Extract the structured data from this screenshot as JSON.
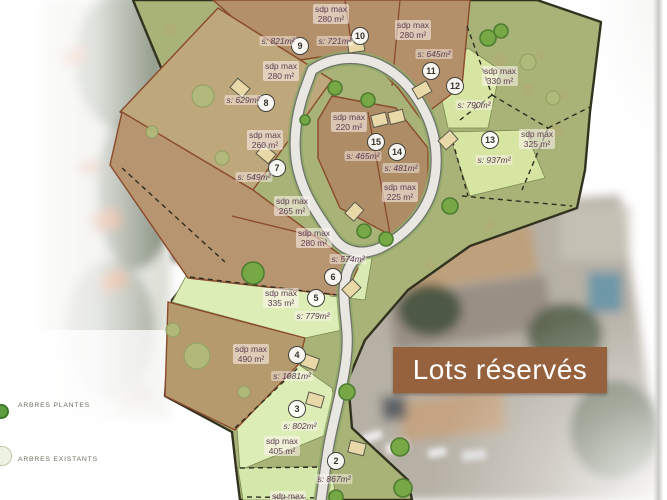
{
  "banner": {
    "label": "Lots réservés"
  },
  "legend": {
    "items": [
      {
        "label": "ARBRES PLANTES"
      },
      {
        "label": "ARBRES EXISTANTS"
      }
    ]
  },
  "lots": [
    {
      "num": "2",
      "sdp_title": "sdp max",
      "sdp_value": "405 m²",
      "surface": "s: 867m²"
    },
    {
      "num": "3",
      "surface": "s: 802m²"
    },
    {
      "num": "4",
      "sdp_title": "sdp max",
      "sdp_value": "490 m²",
      "surface": "s: 1081m²"
    },
    {
      "num": "5",
      "sdp_title": "sdp max",
      "sdp_value": "335 m²",
      "surface": "s: 779m²"
    },
    {
      "num": "6",
      "sdp_title": "sdp max",
      "sdp_value": "280 m²",
      "surface": "s: 574m²"
    },
    {
      "num": "7",
      "sdp_title": "sdp max",
      "sdp_value": "260 m²",
      "surface": "s: 549m²"
    },
    {
      "num": "8",
      "sdp_title": "sdp max",
      "sdp_value": "280 m²",
      "surface": "s: 629m²"
    },
    {
      "num": "9",
      "surface": "s: 821m²"
    },
    {
      "num": "10",
      "sdp_title": "sdp max",
      "sdp_value": "280 m²",
      "surface": "s: 721m²"
    },
    {
      "num": "11",
      "sdp_title": "sdp max",
      "sdp_value": "280 m²",
      "surface": "s: 645m²"
    },
    {
      "num": "12",
      "sdp_title": "sdp max",
      "sdp_value": "330 m²",
      "surface": "s: 790m²"
    },
    {
      "num": "13",
      "sdp_title": "sdp max",
      "sdp_value": "325 m²",
      "surface": "s: 937m²"
    },
    {
      "num": "14",
      "sdp_title": "sdp max",
      "sdp_value": "225 m²",
      "surface": "s: 481m²"
    },
    {
      "num": "15",
      "sdp_title": "sdp max",
      "sdp_value": "220 m²",
      "surface": "s: 465m²"
    }
  ],
  "unnumbered_labels": {
    "strip_sdp_title": "sdp max",
    "strip_sdp_value": "265 m²",
    "bottom_partial_sdp": "sdp max"
  },
  "colors": {
    "banner_bg": "#96613D",
    "site_green": "#A9B377",
    "lot_brown": "#B3906A",
    "lot_light_green": "#DCEDB6",
    "label_text": "#5F3D52"
  }
}
